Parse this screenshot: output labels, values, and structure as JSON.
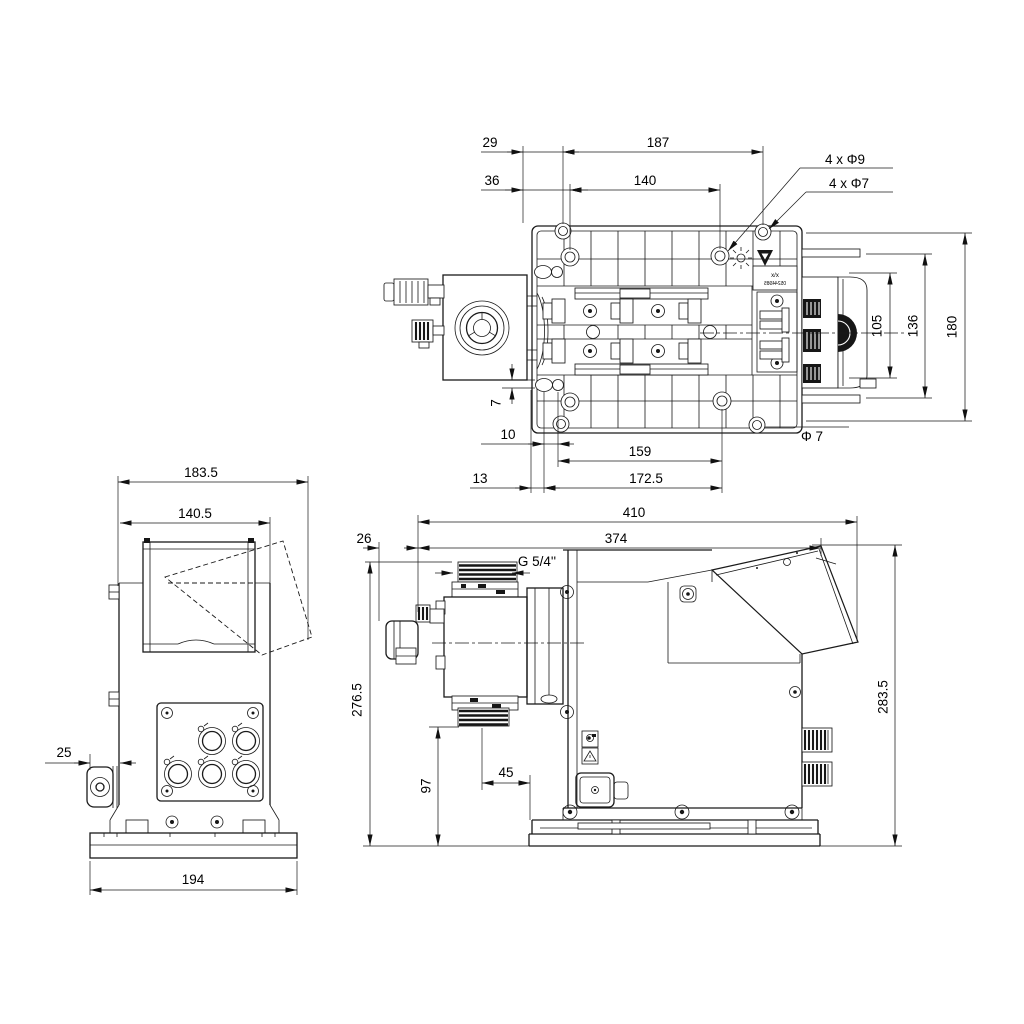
{
  "top_view": {
    "d29": "29",
    "d187": "187",
    "d36": "36",
    "d140": "140",
    "holes_9": "4 x Φ9",
    "holes_7": "4 x Φ7",
    "d105": "105",
    "d136": "136",
    "d180": "180",
    "d7": "7",
    "d10": "10",
    "d159": "159",
    "d13": "13",
    "d172_5": "172.5",
    "phi7": "Φ 7",
    "plate_label": "x/x",
    "plate_number": "05244985"
  },
  "back_view": {
    "d183_5": "183.5",
    "d140_5": "140.5",
    "d25": "25",
    "d194": "194"
  },
  "side_view": {
    "d410": "410",
    "d374": "374",
    "d26": "26",
    "thread": "G 5/4''",
    "d276_5": "276.5",
    "d97": "97",
    "d45": "45",
    "d283_5": "283.5"
  }
}
